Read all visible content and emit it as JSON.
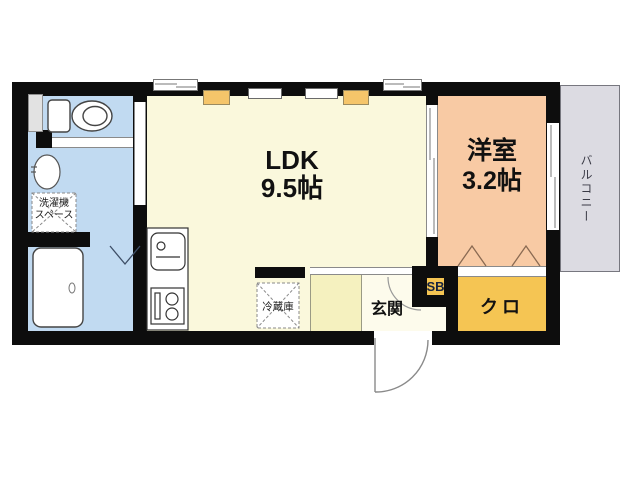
{
  "floorplan": {
    "rooms": {
      "ldk": {
        "name": "LDK",
        "size": "9.5帖"
      },
      "western_room": {
        "name": "洋室",
        "size": "3.2帖"
      },
      "balcony": {
        "name": "バルコニー"
      },
      "entrance": {
        "name": "玄関"
      },
      "closet": {
        "name": "クロ"
      },
      "shoe_box": {
        "name": "SB"
      }
    },
    "fixtures": {
      "washer_space": {
        "line1": "洗濯機",
        "line2": "スペース"
      },
      "refrigerator": {
        "name": "冷蔵庫"
      }
    },
    "colors": {
      "wall": "#0d0d0d",
      "ldk_floor": "#faf8dc",
      "western_floor": "#f8caa4",
      "wet_area_floor": "#c1daf1",
      "closet_floor": "#f5c553",
      "hall_floor": "#f5f1bf",
      "entrance_floor": "#fdfbec",
      "balcony_floor": "#dcdbe2",
      "wall_cabinet": "#f5c56a"
    }
  }
}
